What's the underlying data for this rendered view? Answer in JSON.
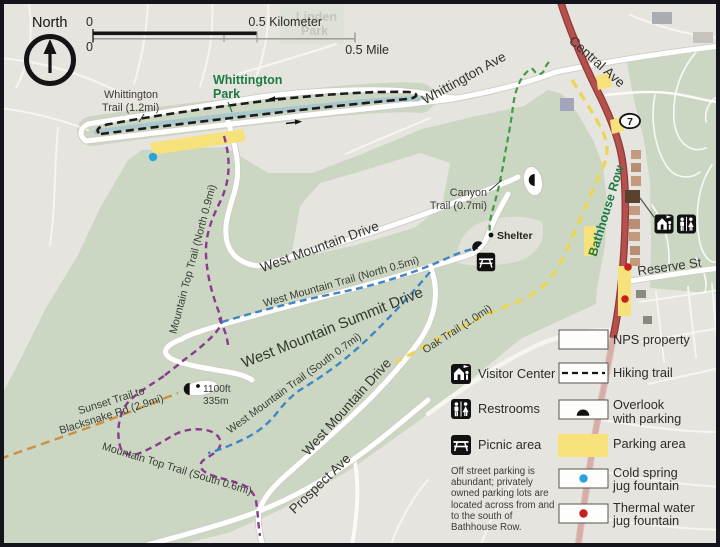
{
  "compass": {
    "label": "North"
  },
  "scale": {
    "zero_top": "0",
    "km": "0.5 Kilometer",
    "zero_bottom": "0",
    "mi": "0.5 Mile"
  },
  "places": {
    "linden_1": "Linden",
    "linden_2": "Park",
    "wpark_1": "Whittington",
    "wpark_2": "Park"
  },
  "roads": {
    "whittington_ave": "Whittington Ave",
    "central_ave": "Central Ave",
    "route_number": "7",
    "bathhouse_row": "Bathhouse Row",
    "reserve_st": "Reserve St",
    "west_mountain_drive": "West Mountain Drive",
    "summit_drive": "West Mountain Summit Drive",
    "prospect_ave": "Prospect Ave"
  },
  "trails": {
    "whittington_1": "Whittington",
    "whittington_2": "Trail (1.2mi)",
    "canyon_1": "Canyon",
    "canyon_2": "Trail (0.7mi)",
    "west_north": "West Mountain Trail (North 0.5mi)",
    "west_south": "West Mountain Trail (South 0.7mi)",
    "top_north": "Mountain Top Trail (North 0.9mi)",
    "top_south": "Mountain Top Trail (South 0.6mi)",
    "sunset_1": "Sunset Trail to",
    "sunset_2": "Blacksnake Rd (2.9mi)",
    "oak": "Oak Trail (1.0mi)"
  },
  "poi": {
    "shelter": "Shelter",
    "elev_ft": "1100ft",
    "elev_m": "335m"
  },
  "legend": {
    "nps": "NPS property",
    "hiking": "Hiking trail",
    "visitor": "Visitor Center",
    "restrooms": "Restrooms",
    "overlook_1": "Overlook",
    "overlook_2": "with parking",
    "picnic": "Picnic area",
    "parking": "Parking area",
    "cold_1": "Cold spring",
    "cold_2": "jug fountain",
    "thermal_1": "Thermal water",
    "thermal_2": "jug fountain",
    "parking_note": "Off street parking is abundant; privately owned parking lots are located across from and to the south of Bathhouse Row."
  },
  "colors": {
    "nps_green": "#cbd7c2",
    "parking_yellow": "#f7e17a",
    "road_red": "#b5504c",
    "trail_black": "#1c1c1a",
    "trail_blue": "#3f87c4",
    "trail_purple": "#8b3a8f",
    "trail_green": "#3f9b45",
    "trail_yellow": "#ecd455",
    "trail_orange": "#cd9040",
    "cold_blue": "#29a3dc",
    "thermal_red": "#c5201d",
    "park_text_green": "#1e7a44"
  }
}
